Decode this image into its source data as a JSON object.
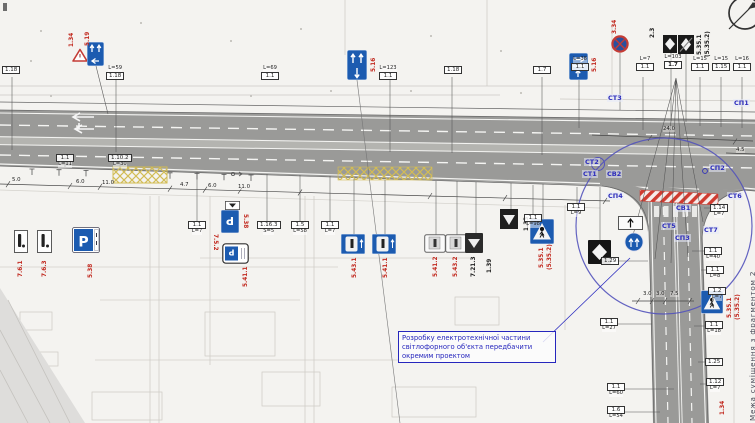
{
  "colors": {
    "road": "#9a9a98",
    "median": "#b4b4b0",
    "sign_blue": "#1c5bb0",
    "red_code": "#c22a20",
    "marker_blue": "#2d2dbb",
    "callout_blue": "#2626bd",
    "yellow_hatch": "#d2bc55",
    "red_hatch": "#cf3b30",
    "circle_blue": "#5353bb"
  },
  "callout": {
    "text": "Розробку електротехнічної частини світлофорного об'єкта передбачити окремим проектом"
  },
  "corner": {
    "text": "Межа суміщення з фрагментом 2"
  },
  "signs": {
    "parking_letter": "Р"
  },
  "markers": [
    {
      "t": "СТ3",
      "x": 607,
      "y": 94
    },
    {
      "t": "СП1",
      "x": 733,
      "y": 99
    },
    {
      "t": "СТ2",
      "x": 584,
      "y": 158
    },
    {
      "t": "СТ1",
      "x": 582,
      "y": 170
    },
    {
      "t": "СВ2",
      "x": 606,
      "y": 170
    },
    {
      "t": "СП4",
      "x": 607,
      "y": 192
    },
    {
      "t": "СП2",
      "x": 709,
      "y": 164
    },
    {
      "t": "СТ6",
      "x": 727,
      "y": 192
    },
    {
      "t": "СВ1",
      "x": 675,
      "y": 204
    },
    {
      "t": "СТ5",
      "x": 661,
      "y": 222
    },
    {
      "t": "СП3",
      "x": 674,
      "y": 234
    },
    {
      "t": "СТ7",
      "x": 703,
      "y": 226
    }
  ],
  "sign_codes": [
    {
      "t": "1.34",
      "x": 69,
      "y": 47,
      "rot": -90
    },
    {
      "t": "5.19",
      "x": 85,
      "y": 46,
      "rot": -90
    },
    {
      "t": "5.16",
      "x": 371,
      "y": 72,
      "rot": -90
    },
    {
      "t": "5.16",
      "x": 592,
      "y": 72,
      "rot": -90
    },
    {
      "t": "3.34",
      "x": 612,
      "y": 34,
      "rot": -90
    },
    {
      "t": "2.3",
      "x": 650,
      "y": 38,
      "rot": -90,
      "c": "#222"
    },
    {
      "t": "5.35.1",
      "x": 697,
      "y": 55,
      "rot": -90,
      "c": "#222"
    },
    {
      "t": "(5.35.2)",
      "x": 705,
      "y": 57,
      "rot": -90,
      "c": "#222"
    },
    {
      "t": "7.6.1",
      "x": 18,
      "y": 277,
      "rot": -90
    },
    {
      "t": "7.6.3",
      "x": 42,
      "y": 277,
      "rot": -90
    },
    {
      "t": "5.38",
      "x": 88,
      "y": 278,
      "rot": -90
    },
    {
      "t": "7.5.2",
      "x": 218,
      "y": 234,
      "rot": 90
    },
    {
      "t": "5.38",
      "x": 248,
      "y": 214,
      "rot": 90
    },
    {
      "t": "5.41.1",
      "x": 243,
      "y": 287,
      "rot": -90
    },
    {
      "t": "5.43.1",
      "x": 352,
      "y": 278,
      "rot": -90
    },
    {
      "t": "5.41.1",
      "x": 383,
      "y": 278,
      "rot": -90
    },
    {
      "t": "5.41.2",
      "x": 433,
      "y": 277,
      "rot": -90
    },
    {
      "t": "5.43.2",
      "x": 453,
      "y": 277,
      "rot": -90
    },
    {
      "t": "7.21.3",
      "x": 471,
      "y": 277,
      "rot": -90,
      "c": "#222"
    },
    {
      "t": "1.39",
      "x": 487,
      "y": 273,
      "rot": -90,
      "c": "#222"
    },
    {
      "t": "1.33",
      "x": 524,
      "y": 231,
      "rot": -90,
      "c": "#222"
    },
    {
      "t": "5.35.1",
      "x": 539,
      "y": 268,
      "rot": -90
    },
    {
      "t": "(5.35.2)",
      "x": 547,
      "y": 270,
      "rot": -90
    },
    {
      "t": "5.35.1",
      "x": 727,
      "y": 318,
      "rot": -90
    },
    {
      "t": "(5.35.2)",
      "x": 735,
      "y": 320,
      "rot": -90
    },
    {
      "t": "1.34",
      "x": 720,
      "y": 415,
      "rot": -90
    }
  ],
  "label_boxes": [
    {
      "x": 2,
      "y": 66,
      "code": "1.18"
    },
    {
      "x": 106,
      "y": 66,
      "code": "1.18",
      "sup": "L=59"
    },
    {
      "x": 261,
      "y": 66,
      "code": "1.1",
      "sup": "L=69"
    },
    {
      "x": 379,
      "y": 66,
      "code": "1.1",
      "sup": "L=123"
    },
    {
      "x": 444,
      "y": 66,
      "code": "1.18"
    },
    {
      "x": 533,
      "y": 66,
      "code": "1.7"
    },
    {
      "x": 571,
      "y": 57,
      "code": "1.1",
      "sup": "L=38"
    },
    {
      "x": 636,
      "y": 57,
      "code": "1.1",
      "sup": "L=7"
    },
    {
      "x": 664,
      "y": 55,
      "code": "1.7",
      "sup": "L=103",
      "bold": true
    },
    {
      "x": 691,
      "y": 57,
      "code": "1.1",
      "sup": "L=15"
    },
    {
      "x": 712,
      "y": 57,
      "code": "1.15",
      "sup": "L=15"
    },
    {
      "x": 733,
      "y": 57,
      "code": "1.1",
      "sup": "L=16"
    },
    {
      "x": 56,
      "y": 154,
      "code": "1.1",
      "sub": "L=11"
    },
    {
      "x": 108,
      "y": 154,
      "code": "1.10.2",
      "sub": "L=30"
    },
    {
      "x": 188,
      "y": 221,
      "code": "1.1",
      "sub": "L=7"
    },
    {
      "x": 257,
      "y": 221,
      "code": "1.16.3",
      "sub": "S=5"
    },
    {
      "x": 291,
      "y": 221,
      "code": "1.5",
      "sub": "L=58"
    },
    {
      "x": 321,
      "y": 221,
      "code": "1.1",
      "sub": "L=7"
    },
    {
      "x": 524,
      "y": 214,
      "code": "1.1",
      "sub": "L=98"
    },
    {
      "x": 567,
      "y": 203,
      "code": "1.1",
      "sub": "L=9"
    },
    {
      "x": 710,
      "y": 204,
      "code": "1.14",
      "sub": "L=7"
    },
    {
      "x": 704,
      "y": 247,
      "code": "1.1",
      "sub": "L=40"
    },
    {
      "x": 706,
      "y": 266,
      "code": "1.1",
      "sub": "L=8"
    },
    {
      "x": 708,
      "y": 287,
      "code": "1.2",
      "sub": "L=7"
    },
    {
      "x": 600,
      "y": 318,
      "code": "1.1",
      "sub": "L=27"
    },
    {
      "x": 705,
      "y": 321,
      "code": "1.1",
      "sub": "L=18"
    },
    {
      "x": 705,
      "y": 358,
      "code": "1.25"
    },
    {
      "x": 706,
      "y": 378,
      "code": "1.12",
      "sub": "L=7"
    },
    {
      "x": 607,
      "y": 383,
      "code": "1.1",
      "sub": "L=60"
    },
    {
      "x": 607,
      "y": 406,
      "code": "1.6",
      "sub": "L=54"
    },
    {
      "x": 601,
      "y": 257,
      "code": "1.29"
    }
  ],
  "dimensions": [
    {
      "t": "5.0",
      "x": 12,
      "y": 177
    },
    {
      "t": "6.0",
      "x": 76,
      "y": 179
    },
    {
      "t": "11.0",
      "x": 102,
      "y": 180
    },
    {
      "t": "4.7",
      "x": 180,
      "y": 182
    },
    {
      "t": "6.0",
      "x": 208,
      "y": 183
    },
    {
      "t": "11.0",
      "x": 238,
      "y": 184
    },
    {
      "t": "24.0",
      "x": 663,
      "y": 126
    },
    {
      "t": "4.5",
      "x": 736,
      "y": 147
    },
    {
      "t": "3.0",
      "x": 643,
      "y": 291
    },
    {
      "t": "3.0",
      "x": 656,
      "y": 291
    },
    {
      "t": "7.5",
      "x": 670,
      "y": 291
    }
  ]
}
